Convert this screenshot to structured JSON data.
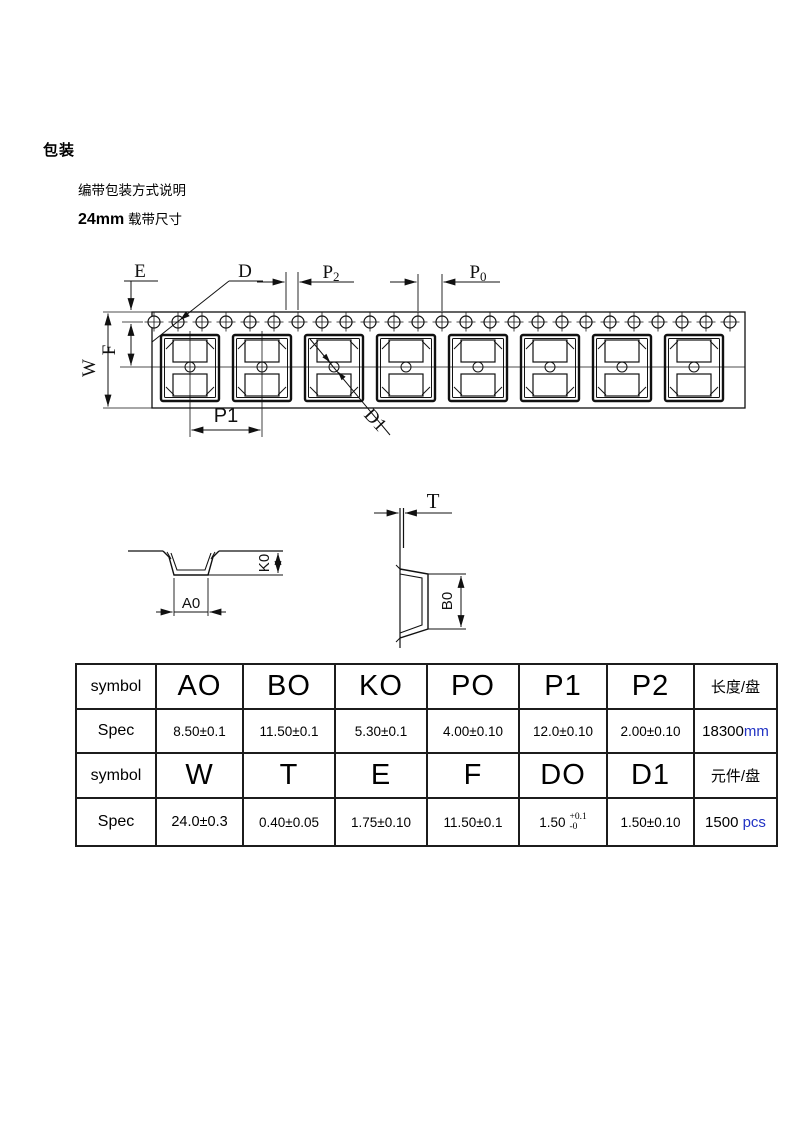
{
  "header": {
    "title": "包装",
    "line1": "编带包装方式说明",
    "line2_bold": "24mm",
    "line2_rest": " 载带尺寸"
  },
  "drawing": {
    "labels": {
      "E": "E",
      "D": "D",
      "P2_base": "P",
      "P2_sub": "2",
      "P0_base": "P",
      "P0_sub": "0",
      "W": "W",
      "F": "F",
      "P1": "P1",
      "D1": "D1",
      "A0": "A0",
      "K0": "K0",
      "T": "T",
      "B0": "B0"
    }
  },
  "table": {
    "symbol_label": "symbol",
    "spec_label": "Spec",
    "row1_symbols": [
      "AO",
      "BO",
      "KO",
      "PO",
      "P1",
      "P2"
    ],
    "row1_last_header": "长度/盘",
    "row1_specs": [
      "8.50±0.1",
      "11.50±0.1",
      "5.30±0.1",
      "4.00±0.10",
      "12.0±0.10",
      "2.00±0.10"
    ],
    "row1_last_value": "18300",
    "row1_last_unit": "mm",
    "row2_symbols": [
      "W",
      "T",
      "E",
      "F",
      "DO",
      "D1"
    ],
    "row2_last_header": "元件/盘",
    "row2_specs_a": [
      "24.0±0.3",
      "0.40±0.05",
      "1.75±0.10",
      "11.50±0.1"
    ],
    "row2_do_spec": {
      "base": "1.50",
      "upper": "+0.1",
      "lower": "-0"
    },
    "row2_d1_spec": "1.50±0.10",
    "row2_last_value": "1500",
    "row2_last_unit": "pcs"
  },
  "colors": {
    "ink": "#111111",
    "unit_text": "#2233c4",
    "background": "#ffffff"
  }
}
